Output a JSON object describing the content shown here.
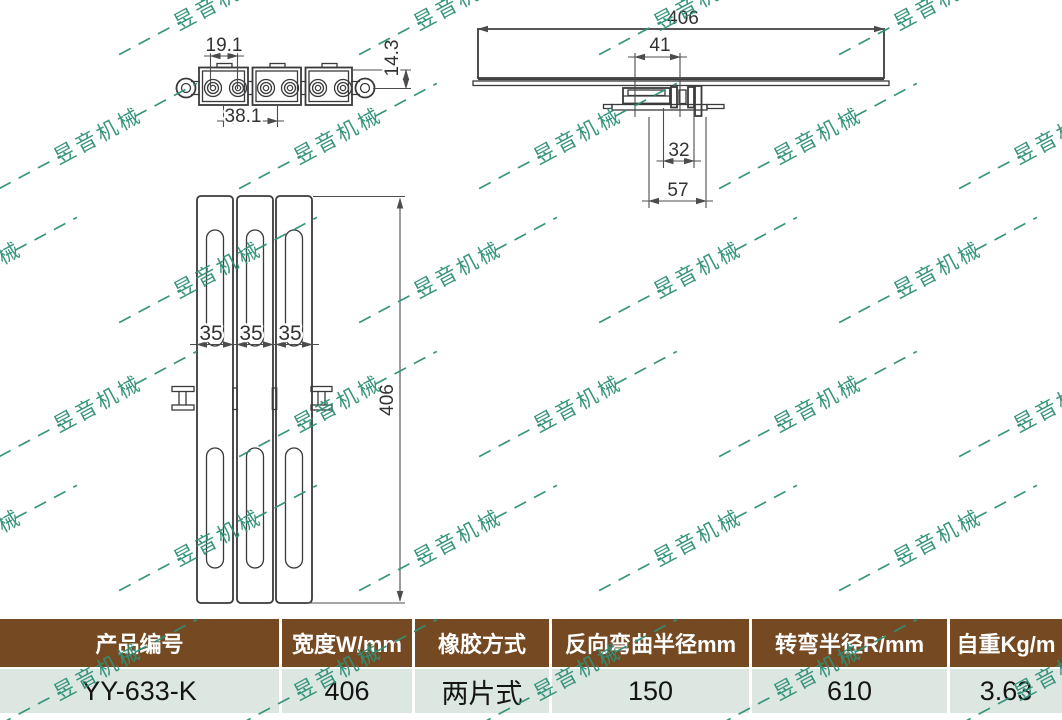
{
  "watermark": {
    "text": "昱音机械",
    "color": "#2e8f77"
  },
  "drawing": {
    "side_view": {
      "dim_pitch": "19.1",
      "dim_double_pitch": "38.1",
      "dim_height": "14.3"
    },
    "section_view": {
      "dim_belt_width": "406",
      "dim_mount_width": "41",
      "dim_inner_width": "32",
      "dim_outer_width": "57"
    },
    "plan_view": {
      "dim_slat_1": "35",
      "dim_slat_2": "35",
      "dim_slat_3": "35",
      "dim_belt_width": "406"
    }
  },
  "table": {
    "header_bg": "#754a22",
    "row_bg": "#dde7e1",
    "headers": [
      "产品编号",
      "宽度W/mm",
      "橡胶方式",
      "反向弯曲半径mm",
      "转弯半径R/mm",
      "自重Kg/m"
    ],
    "rows": [
      [
        "YY-633-K",
        "406",
        "两片式",
        "150",
        "610",
        "3.63"
      ]
    ]
  }
}
